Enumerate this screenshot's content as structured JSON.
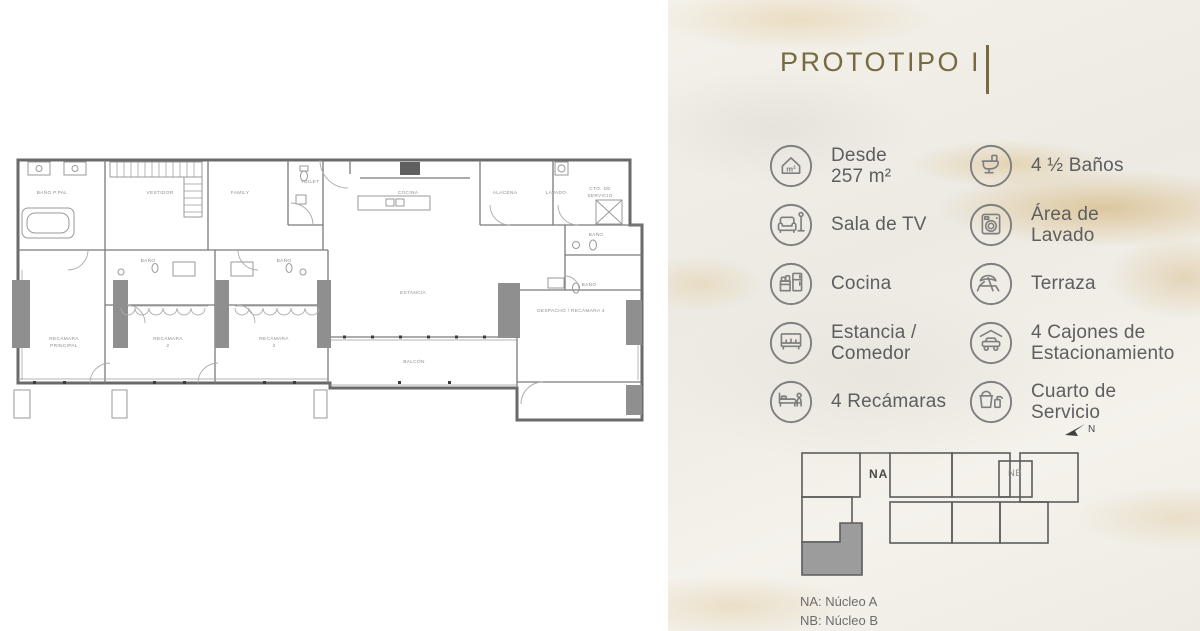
{
  "title": {
    "text": "PROTOTIPO I"
  },
  "features": {
    "items": [
      {
        "icon": "area-icon",
        "label": "Desde\n257 m²"
      },
      {
        "icon": "toilet-icon",
        "label": "4 ½ Baños"
      },
      {
        "icon": "sofa-icon",
        "label": "Sala de TV"
      },
      {
        "icon": "washer-icon",
        "label": "Área de\nLavado"
      },
      {
        "icon": "kitchen-icon",
        "label": "Cocina"
      },
      {
        "icon": "terrace-icon",
        "label": "Terraza"
      },
      {
        "icon": "dining-icon",
        "label": "Estancia /\nComedor"
      },
      {
        "icon": "parking-icon",
        "label": "4 Cajones de\nEstacionamiento"
      },
      {
        "icon": "bed-icon",
        "label": "4 Recámaras"
      },
      {
        "icon": "service-icon",
        "label": "Cuarto de\nServicio"
      }
    ]
  },
  "key_plan": {
    "label_na": "NA",
    "label_nb": "NB",
    "north_label": "N",
    "legend": [
      "NA: Núcleo A",
      "NB: Núcleo B"
    ]
  },
  "floor_plan": {
    "rooms": [
      {
        "label": "BAÑO P.PAL",
        "x": 44,
        "y": 44
      },
      {
        "label": "VESTIDOR",
        "x": 152,
        "y": 44
      },
      {
        "label": "FAMILY",
        "x": 232,
        "y": 44
      },
      {
        "label": "TOILET",
        "x": 302,
        "y": 33
      },
      {
        "label": "COCINA",
        "x": 400,
        "y": 44
      },
      {
        "label": "ALACENA",
        "x": 497,
        "y": 44
      },
      {
        "label": "LAVADO",
        "x": 548,
        "y": 44
      },
      {
        "label": "CTO. DE",
        "x": 592,
        "y": 40
      },
      {
        "label": "SERVICIO",
        "x": 592,
        "y": 47
      },
      {
        "label": "BAÑO",
        "x": 588,
        "y": 86
      },
      {
        "label": "BAÑO",
        "x": 581,
        "y": 136
      },
      {
        "label": "BAÑO",
        "x": 140,
        "y": 112
      },
      {
        "label": "BAÑO",
        "x": 276,
        "y": 112
      },
      {
        "label": "RECÁMARA",
        "x": 56,
        "y": 190
      },
      {
        "label": "PRINCIPAL",
        "x": 56,
        "y": 197
      },
      {
        "label": "RECÁMARA",
        "x": 160,
        "y": 190
      },
      {
        "label": "2",
        "x": 160,
        "y": 197
      },
      {
        "label": "RECÁMARA",
        "x": 266,
        "y": 190
      },
      {
        "label": "3",
        "x": 266,
        "y": 197
      },
      {
        "label": "ESTANCIA",
        "x": 405,
        "y": 144
      },
      {
        "label": "BALCÓN",
        "x": 406,
        "y": 213
      },
      {
        "label": "DESPACHO / RECÁMARA 4",
        "x": 563,
        "y": 162
      }
    ]
  },
  "colors": {
    "accent": "#776a41",
    "icon_gray": "#7f7f7f",
    "text_gray": "#5e5e5e",
    "marble_base": "#f0ede6",
    "marble_vein": "#d9c193",
    "plan_line": "#6a6a6a",
    "unit_highlight": "#9c9c9c"
  }
}
